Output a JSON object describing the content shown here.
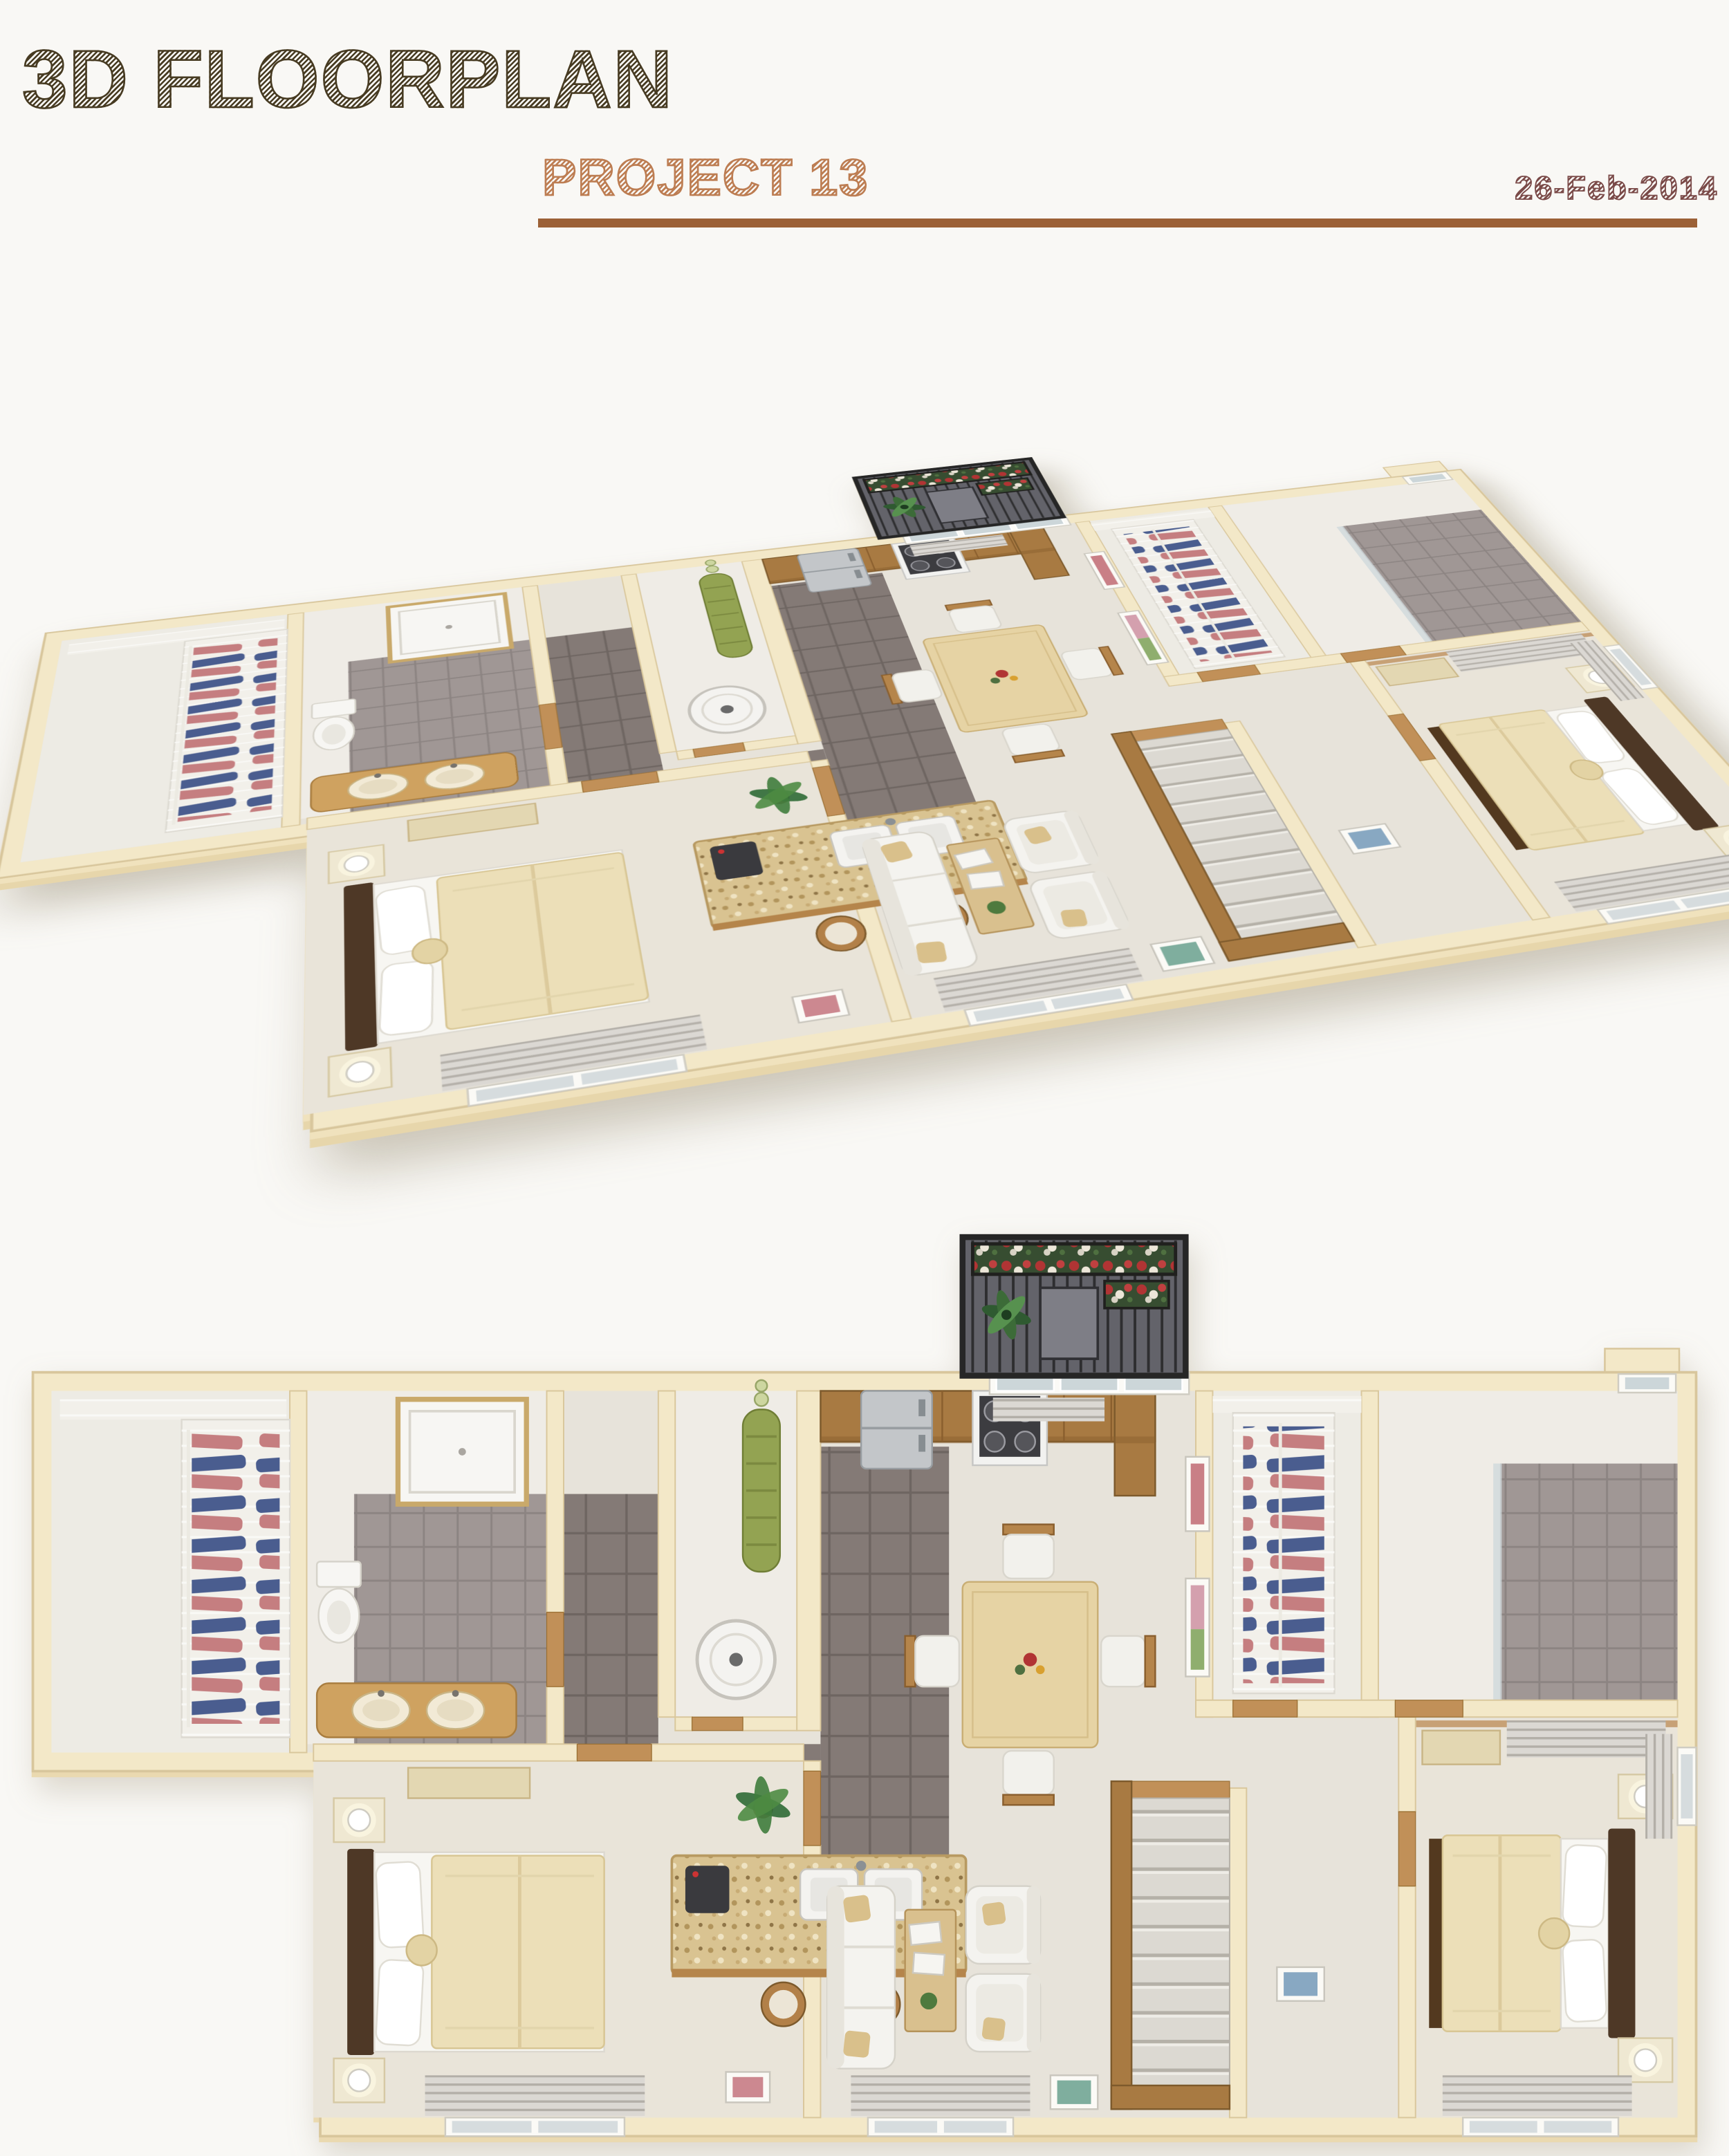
{
  "header": {
    "title": "3D FLOORPLAN",
    "subtitle": "PROJECT 13",
    "date": "26-Feb-2014"
  },
  "divider": {
    "color": "#9c6137"
  },
  "palette": {
    "page_bg": "#f9f8f5",
    "title_brown": "#473b22",
    "subtitle_sienna": "#bd7d52",
    "date_maroon": "#7a4a48",
    "rule_brown": "#9c6137",
    "wall_cream": "#f3e8c8",
    "wall_edge": "#d8c69c",
    "carpet": "#e7e3da",
    "bedroom_carpet": "#e9e4d9",
    "kitchen_tile": "#847a76",
    "bath_tile": "#a09795",
    "wood": "#a87a42",
    "wood_light": "#c19058",
    "granite": "#d9c391",
    "bedding_cream": "#ecdfb8",
    "headboard_brown": "#4e3826",
    "sofa_white": "#f4f3ef",
    "clothes_blue": "#4a5d8f",
    "clothes_pink": "#c57e80",
    "plant_green": "#2f6a35",
    "balcony_rail": "#262626",
    "flower_red": "#b13434",
    "flower_white": "#ece6d8"
  },
  "views": [
    {
      "id": "isometric",
      "label": "3d-isometric-render"
    },
    {
      "id": "top-down",
      "label": "top-down-render"
    }
  ],
  "rooms": [
    "walk-in-closet-1",
    "bathroom-1",
    "hallway",
    "utility-closet",
    "kitchen",
    "breakfast-bar",
    "dining-area",
    "balcony",
    "walk-in-closet-2",
    "bathroom-2",
    "bedroom-1",
    "living-room",
    "staircase",
    "vestibule",
    "bedroom-2"
  ]
}
